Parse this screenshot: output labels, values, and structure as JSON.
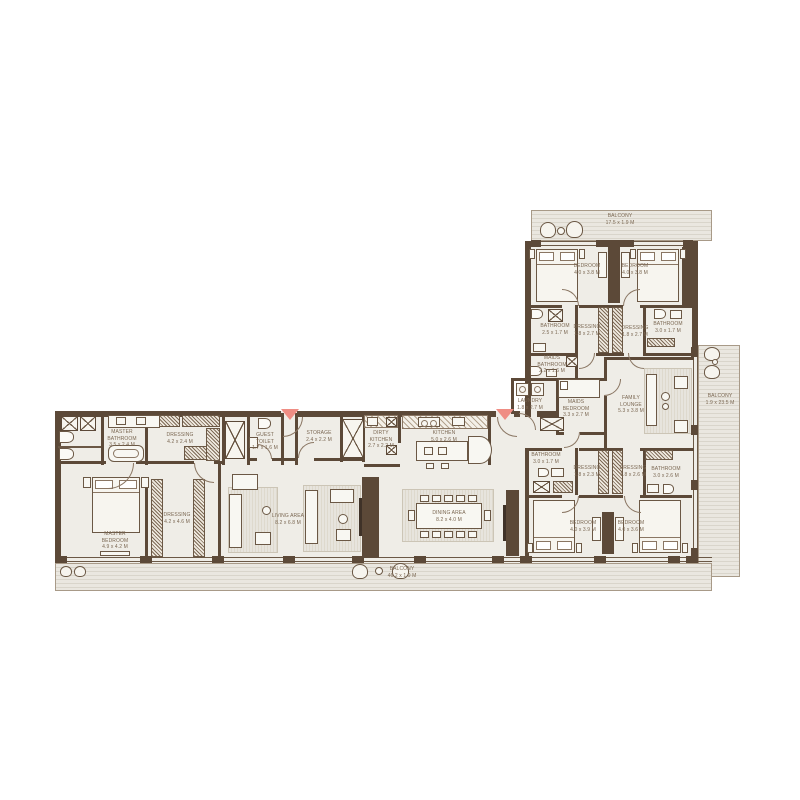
{
  "colors": {
    "wall": "#5c4938",
    "floor": "#efede7",
    "balcony_stripe": "#d9d5cb",
    "entry_marker": "#ef8d84",
    "label_text": "#7b6853",
    "background": "#ffffff"
  },
  "rooms": {
    "balcony_top": {
      "name": "BALCONY",
      "dims": "17.5 x 1.9 M"
    },
    "balcony_right": {
      "name": "BALCONY",
      "dims": "1.9 x 23.5 M"
    },
    "balcony_bottom": {
      "name": "BALCONY",
      "dims": "46.2 x 1.9 M"
    },
    "bedroom1": {
      "name": "BEDROOM",
      "dims": "4.0 x 3.8 M"
    },
    "bedroom2": {
      "name": "BEDROOM",
      "dims": "4.0 x 3.8 M"
    },
    "bathroom1": {
      "name": "BATHROOM",
      "dims": "2.5 x 1.7 M"
    },
    "dressing1": {
      "name": "DRESSING",
      "dims": "1.8 x 2.7 M"
    },
    "dressing2": {
      "name": "DRESSING",
      "dims": "1.8 x 2.7 M"
    },
    "bathroom2": {
      "name": "BATHROOM",
      "dims": "3.0 x 1.7 M"
    },
    "maids_bathroom": {
      "name": "MAIDS BATHROOM",
      "dims": "2.2 x 1.6 M"
    },
    "laundry": {
      "name": "LAUNDRY",
      "dims": "1.8 x 2.7 M"
    },
    "maids_bedroom": {
      "name": "MAIDS BEDROOM",
      "dims": "3.3 x 2.7 M"
    },
    "family_lounge": {
      "name": "FAMILY LOUNGE",
      "dims": "5.3 x 3.8 M"
    },
    "master_bathroom": {
      "name": "MASTER BATHROOM",
      "dims": "3.5 x 2.4 M"
    },
    "dressing_master_top": {
      "name": "DRESSING",
      "dims": "4.2 x 2.4 M"
    },
    "master_bedroom": {
      "name": "MASTER BEDROOM",
      "dims": "4.9 x 4.2 M"
    },
    "dressing_master": {
      "name": "DRESSING",
      "dims": "4.2 x 4.6 M"
    },
    "guest_toilet": {
      "name": "GUEST TOILET",
      "dims": "1.7 x 1.6 M"
    },
    "storage": {
      "name": "STORAGE",
      "dims": "2.4 x 2.2 M"
    },
    "dirty_kitchen": {
      "name": "DIRTY KITCHEN",
      "dims": "2.7 x 2.2 M"
    },
    "kitchen": {
      "name": "KITCHEN",
      "dims": "5.0 x 2.6 M"
    },
    "living_area": {
      "name": "LIVING AREA",
      "dims": "8.2 x 6.8 M"
    },
    "dining_area": {
      "name": "DINING AREA",
      "dims": "8.2 x 4.0 M"
    },
    "bathroom3": {
      "name": "BATHROOM",
      "dims": "3.0 x 1.7 M"
    },
    "dressing3": {
      "name": "DRESSING",
      "dims": "1.8 x 2.3 M"
    },
    "dressing4": {
      "name": "DRESSING",
      "dims": "1.8 x 2.6 M"
    },
    "bathroom4": {
      "name": "BATHROOM",
      "dims": "3.0 x 2.6 M"
    },
    "bedroom3": {
      "name": "BEDROOM",
      "dims": "4.0 x 3.9 M"
    },
    "bedroom4": {
      "name": "BEDROOM",
      "dims": "4.0 x 3.6 M"
    }
  }
}
